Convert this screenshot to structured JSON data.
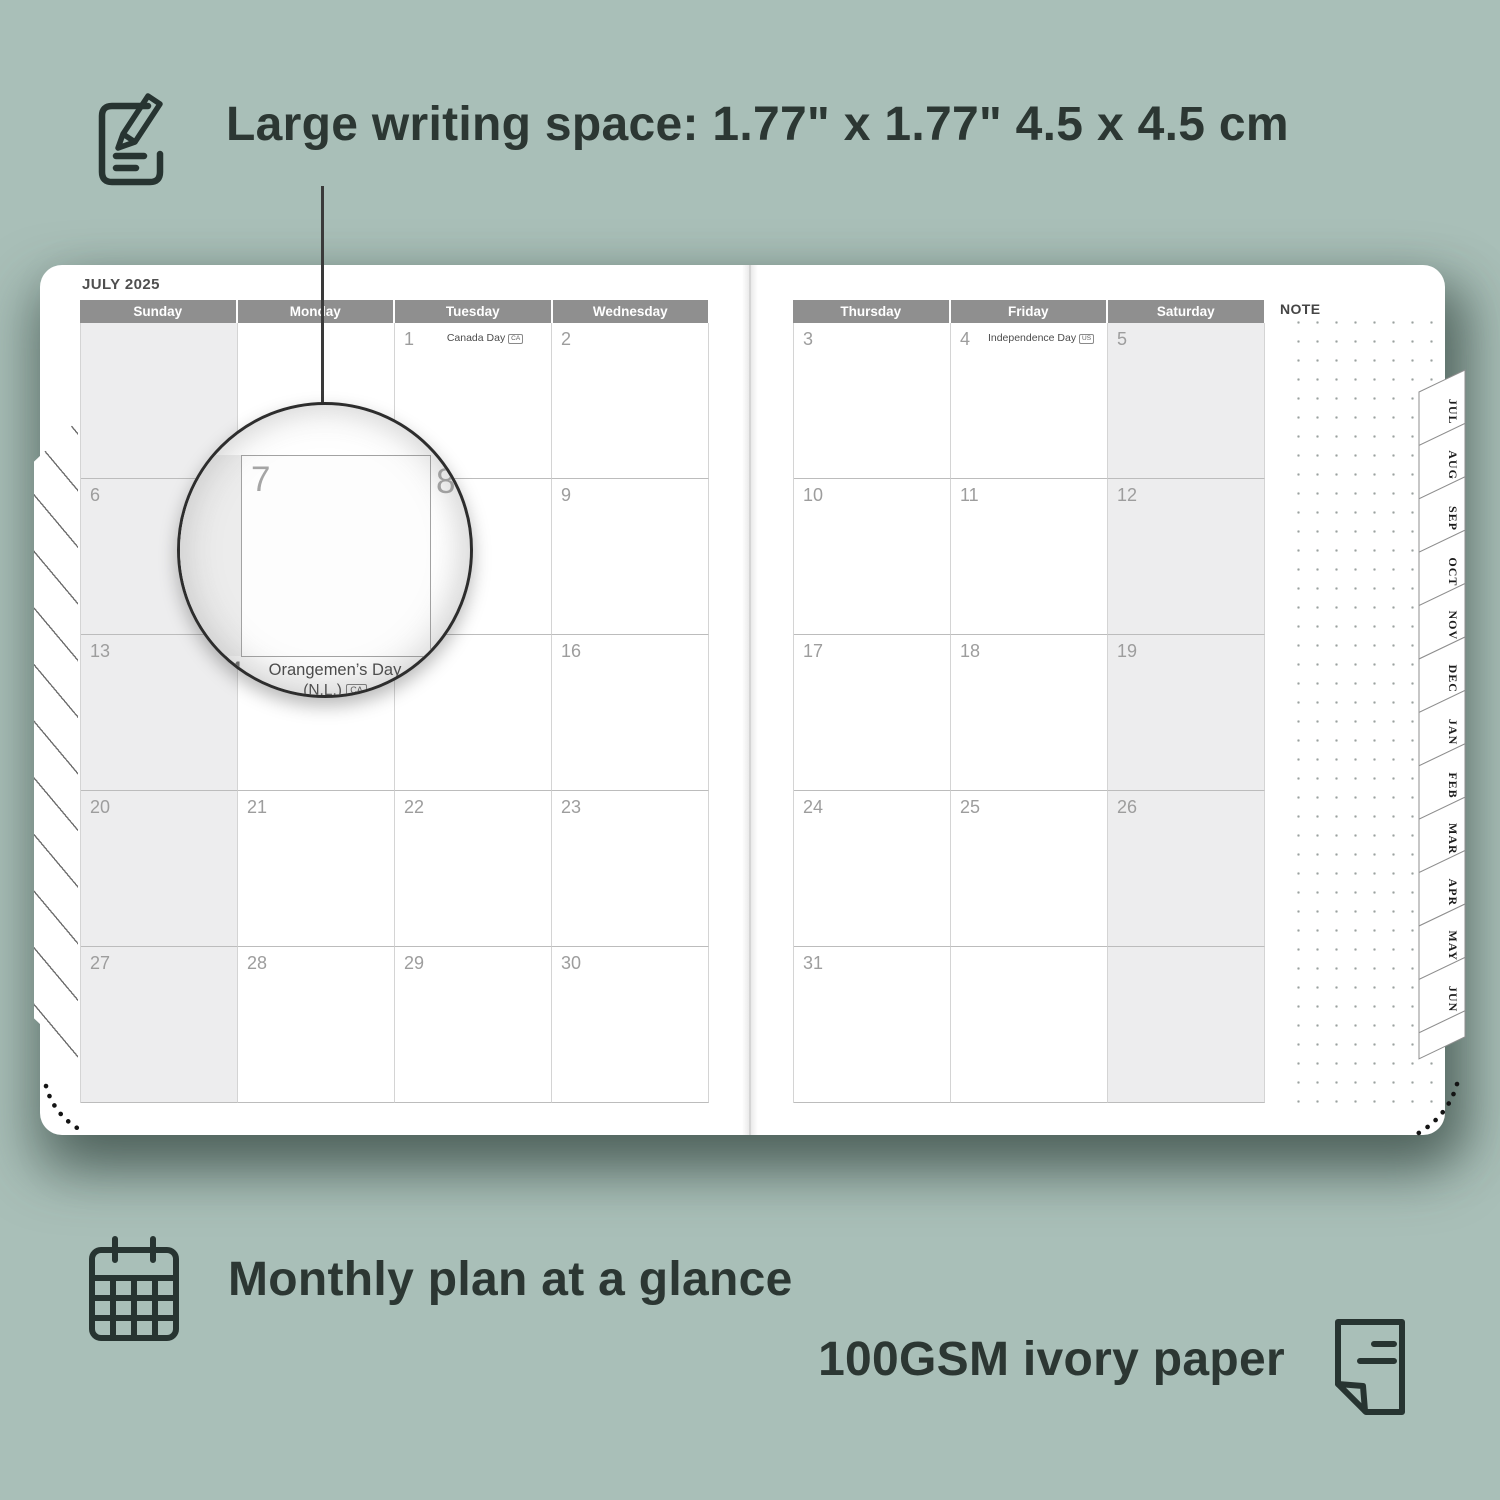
{
  "features": {
    "writing_space_label": "Large writing space: 1.77\" x 1.77\" 4.5 x 4.5 cm",
    "monthly_plan_label": "Monthly plan at a glance",
    "paper_label": "100GSM ivory paper"
  },
  "planner": {
    "month_title": "JULY 2025",
    "note_label": "NOTE",
    "weekdays_left": [
      "Sunday",
      "Monday",
      "Tuesday",
      "Wednesday"
    ],
    "weekdays_right": [
      "Thursday",
      "Friday",
      "Saturday"
    ],
    "month_tabs": [
      "JUL",
      "AUG",
      "SEP",
      "OCT",
      "NOV",
      "DEC",
      "JAN",
      "FEB",
      "MAR",
      "APR",
      "MAY",
      "JUN"
    ],
    "grid_left": [
      [
        {
          "d": ""
        },
        {
          "d": ""
        },
        {
          "d": "1",
          "h": "Canada Day",
          "b": "CA"
        },
        {
          "d": "2"
        }
      ],
      [
        {
          "d": "6"
        },
        {
          "d": "7"
        },
        {
          "d": "8"
        },
        {
          "d": "9"
        }
      ],
      [
        {
          "d": "13"
        },
        {
          "d": "14",
          "h": "Orangemen’s Day (N.L.)",
          "b": "CA"
        },
        {
          "d": "15"
        },
        {
          "d": "16"
        }
      ],
      [
        {
          "d": "20"
        },
        {
          "d": "21"
        },
        {
          "d": "22"
        },
        {
          "d": "23"
        }
      ],
      [
        {
          "d": "27"
        },
        {
          "d": "28"
        },
        {
          "d": "29"
        },
        {
          "d": "30"
        }
      ]
    ],
    "grid_right": [
      [
        {
          "d": "3"
        },
        {
          "d": "4",
          "h": "Independence Day",
          "b": "US"
        },
        {
          "d": "5"
        }
      ],
      [
        {
          "d": "10"
        },
        {
          "d": "11"
        },
        {
          "d": "12"
        }
      ],
      [
        {
          "d": "17"
        },
        {
          "d": "18"
        },
        {
          "d": "19"
        }
      ],
      [
        {
          "d": "24"
        },
        {
          "d": "25"
        },
        {
          "d": "26"
        }
      ],
      [
        {
          "d": "31"
        },
        {
          "d": ""
        },
        {
          "d": ""
        }
      ]
    ]
  },
  "magnifier": {
    "day": "7",
    "adjacent_day": "8",
    "below_day": "14",
    "holiday": "Orangemen’s Day",
    "holiday_region": "(N.L.)",
    "holiday_badge": "CA"
  },
  "colors": {
    "background": "#a9bfb8",
    "page": "#ffffff",
    "header_bar": "#8f8f8f",
    "weekend_shade": "#ededee",
    "ink": "#2c3733",
    "day_number": "#9d9d9d"
  }
}
